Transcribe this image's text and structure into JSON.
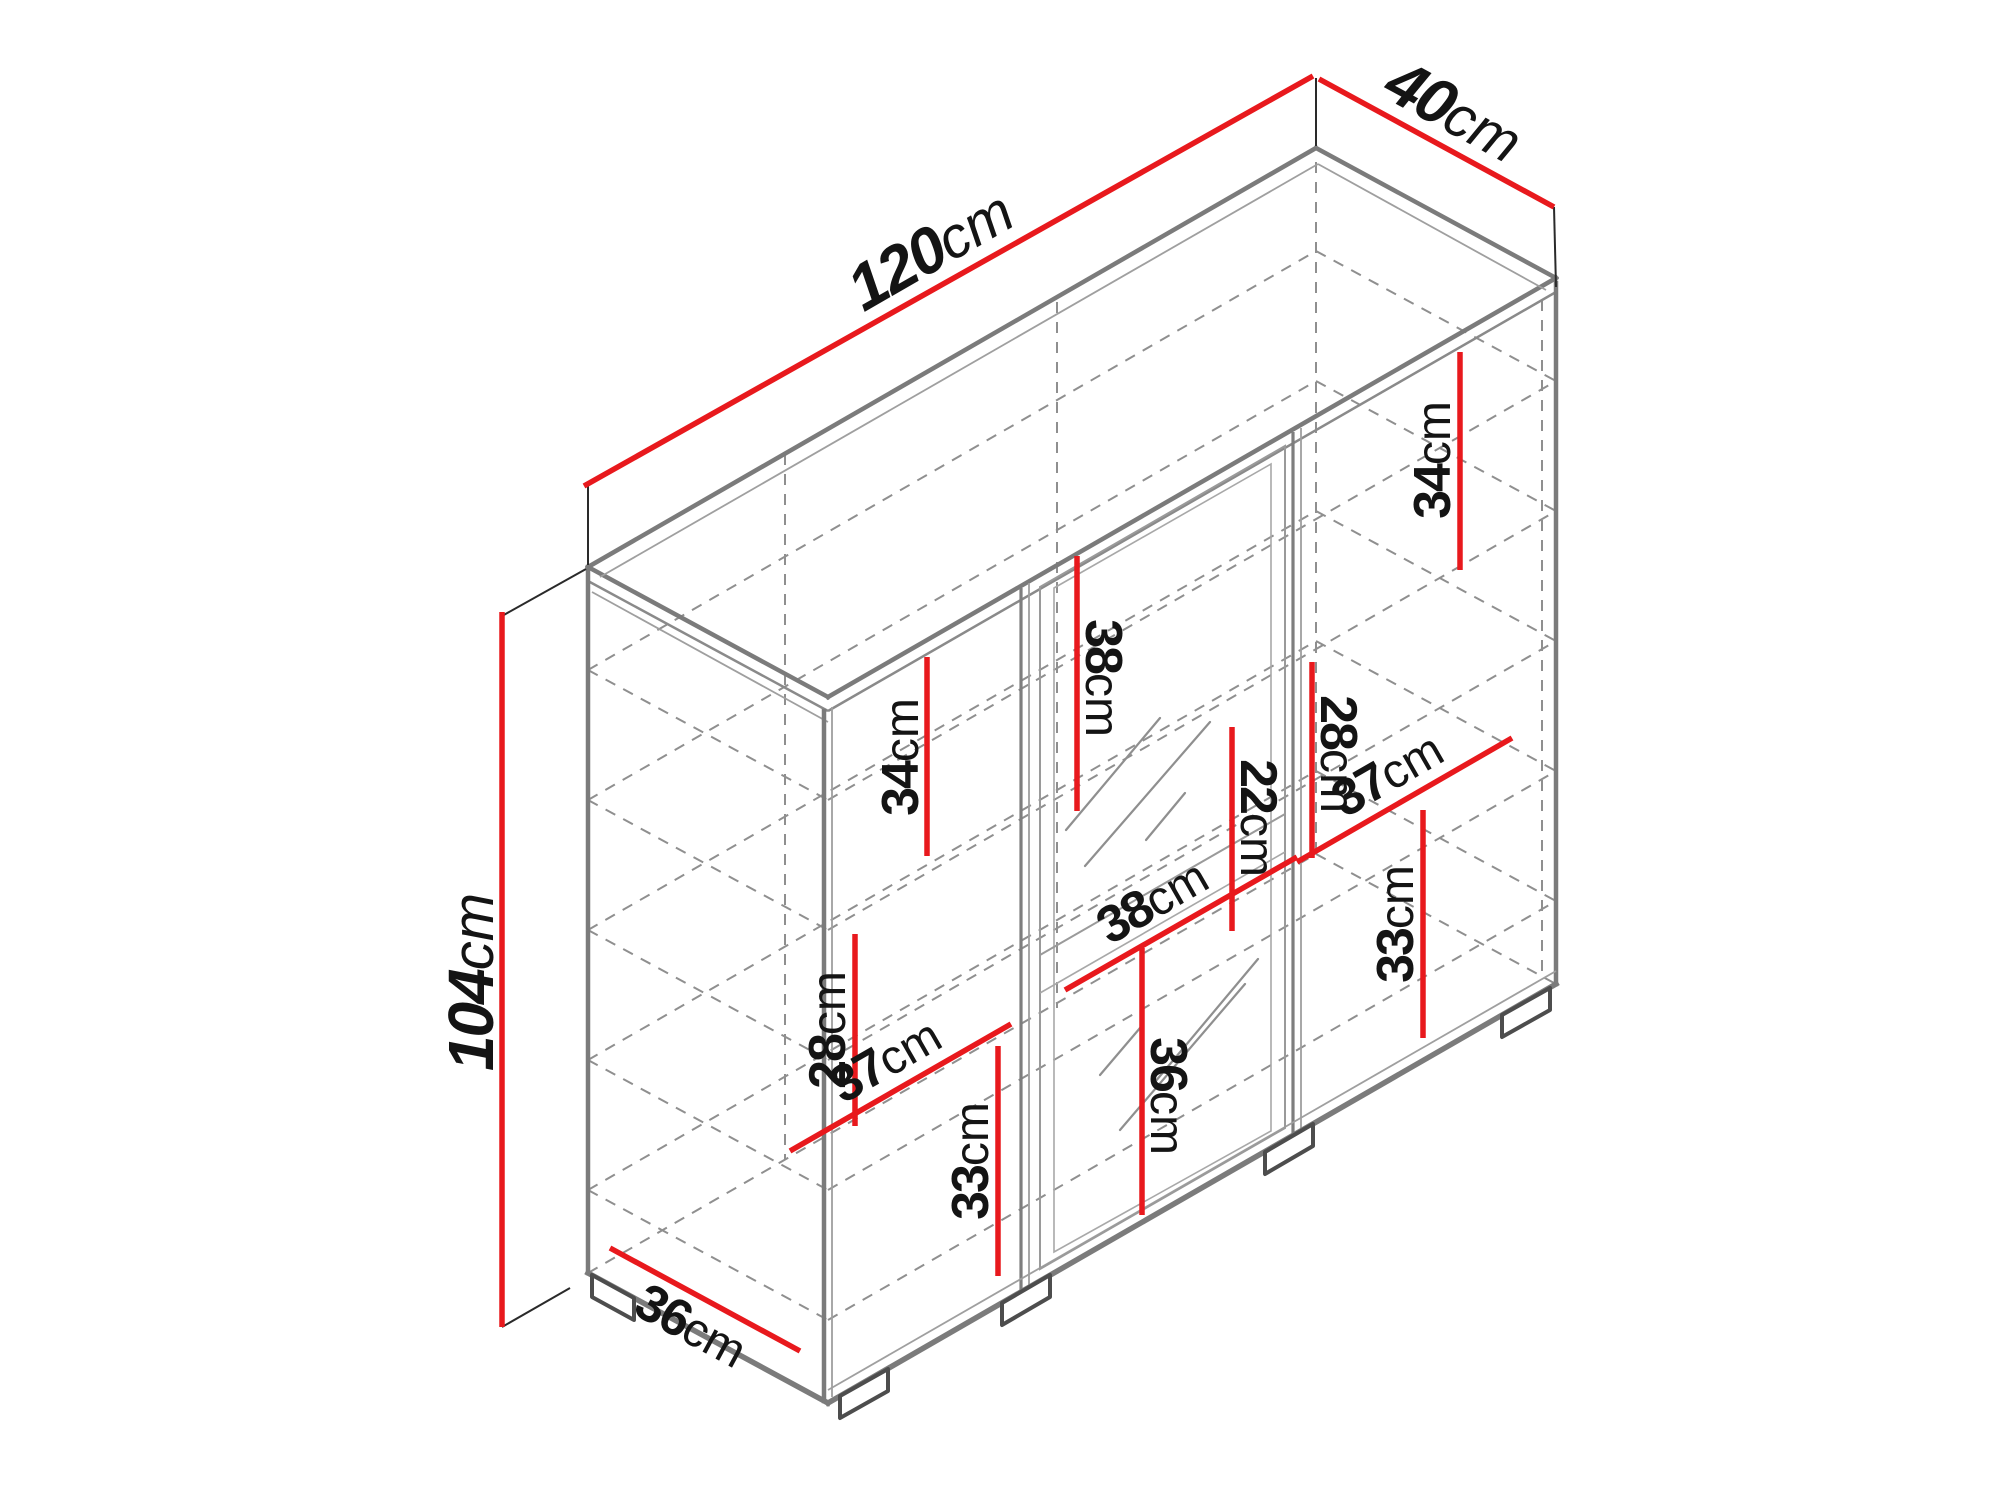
{
  "diagram": {
    "kind": "furniture-dimension-diagram",
    "subject": "sideboard cabinet isometric drawing with shelf dimensions",
    "background": "#ffffff",
    "colors": {
      "dimension_line": "#e8191d",
      "cabinet_edge": "#7b7b7b",
      "hidden_line": "#8f8f8f",
      "extension_line": "#2a2a2a",
      "label_text": "#141414"
    },
    "overall": {
      "width": {
        "value": "120",
        "unit": "cm"
      },
      "depth": {
        "value": "40",
        "unit": "cm"
      },
      "height": {
        "value": "104",
        "unit": "cm"
      }
    },
    "internal": {
      "right_top_gap": {
        "value": "34",
        "unit": "cm"
      },
      "left_top_gap": {
        "value": "34",
        "unit": "cm"
      },
      "center_top_gap": {
        "value": "38",
        "unit": "cm"
      },
      "center_shelf_gap": {
        "value": "22",
        "unit": "cm"
      },
      "center_right_gap": {
        "value": "28",
        "unit": "cm"
      },
      "right_shelf_width": {
        "value": "37",
        "unit": "cm"
      },
      "right_bottom_gap": {
        "value": "33",
        "unit": "cm"
      },
      "left_mid_gap": {
        "value": "28",
        "unit": "cm"
      },
      "left_shelf_width": {
        "value": "37",
        "unit": "cm"
      },
      "center_shelf_width": {
        "value": "38",
        "unit": "cm"
      },
      "left_bottom_gap": {
        "value": "33",
        "unit": "cm"
      },
      "center_bottom_gap": {
        "value": "36",
        "unit": "cm"
      },
      "side_bottom_depth": {
        "value": "36",
        "unit": "cm"
      }
    }
  }
}
